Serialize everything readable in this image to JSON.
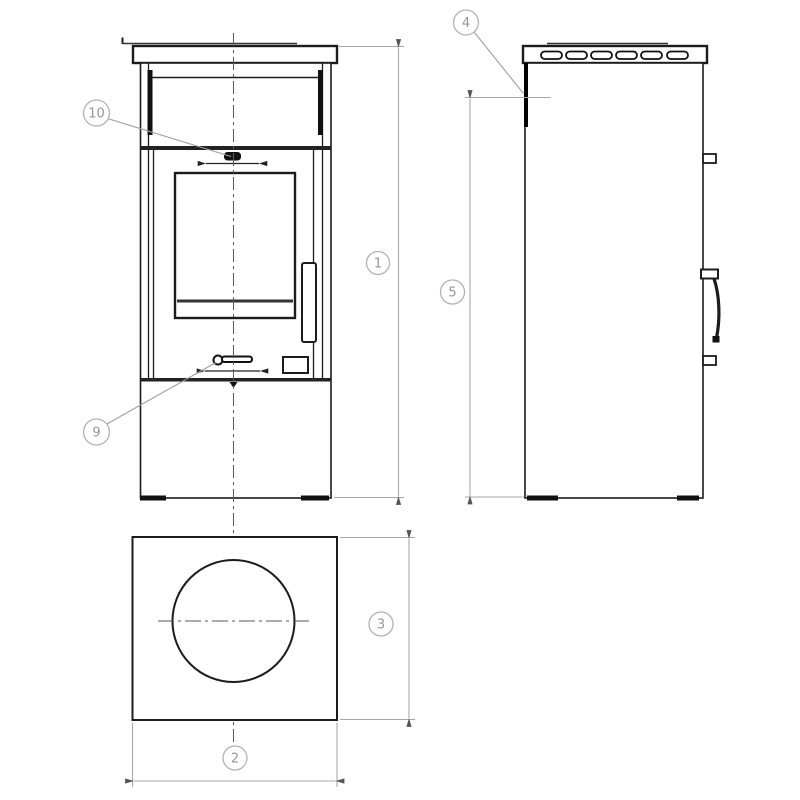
{
  "drawing": {
    "kind": "technical-drawing",
    "subject": "freestanding stove, three orthographic views (front, side, top)"
  },
  "colors": {
    "background": "#ffffff",
    "object_line": "#1c1c1c",
    "thick_line": "#111111",
    "dimension_line": "#a8a8a8",
    "leader_line": "#9f9f9f",
    "label_text": "#969696",
    "arrow": "#555555",
    "centerline": "#5a5a5a"
  },
  "views": {
    "front": {
      "name": "front-view"
    },
    "side": {
      "name": "side-view"
    },
    "top": {
      "name": "top-view"
    }
  },
  "callouts": [
    {
      "number": "10",
      "target": "primary-air-control-knob"
    },
    {
      "number": "9",
      "target": "secondary-air-lever"
    },
    {
      "number": "4",
      "target": "top-rear-edge-side-view"
    }
  ],
  "dimensions": [
    {
      "number": "1",
      "orientation": "vertical",
      "location": "front-view-right",
      "measure": "overall-height"
    },
    {
      "number": "2",
      "orientation": "horizontal",
      "location": "top-view-bottom",
      "measure": "width"
    },
    {
      "number": "3",
      "orientation": "vertical",
      "location": "top-view-right",
      "measure": "depth"
    },
    {
      "number": "5",
      "orientation": "vertical",
      "location": "side-view-left",
      "measure": "body-height"
    }
  ]
}
